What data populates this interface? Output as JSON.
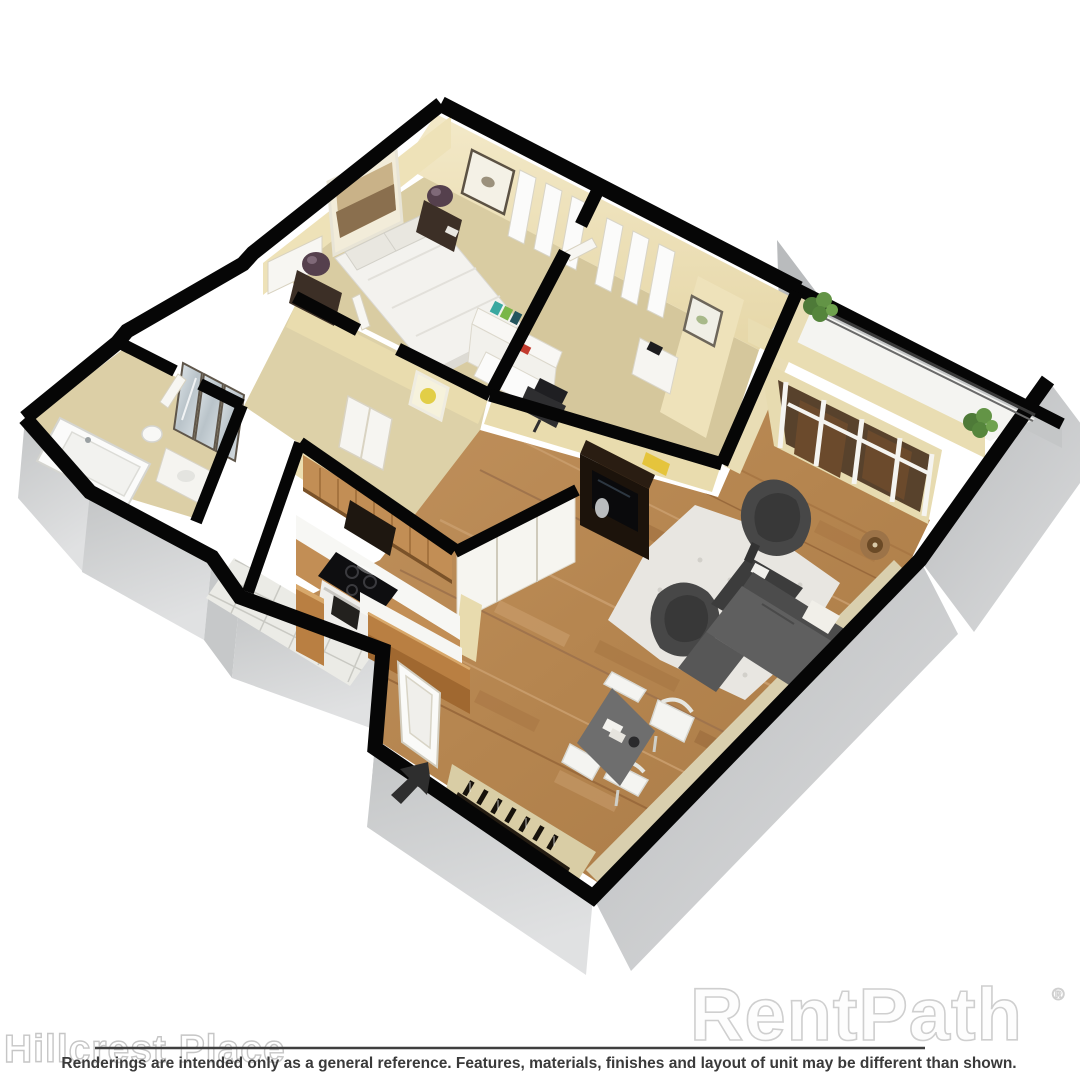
{
  "branding": {
    "property_name": "Hillcrest Place",
    "watermark": "RentPath",
    "registered_mark": "®"
  },
  "footer": {
    "disclaimer": "Renderings are intended only as a general reference. Features, materials, finishes and layout of unit may be different than shown."
  },
  "floor_plan": {
    "style": "3D isometric cutaway rendering of an apartment unit, viewed from above at 45 degrees",
    "rooms": [
      "master bedroom",
      "den office",
      "hallway with mirrored closets",
      "bathroom",
      "galley kitchen with breakfast bar",
      "living room",
      "dining area",
      "entry foyer with wine shelf",
      "balcony with railing and plants"
    ],
    "furniture": {
      "master_bedroom": [
        "queen bed with white bedding",
        "two dark nightstands",
        "two plum table lamps",
        "wide framed art",
        "butterfly framed art",
        "windows"
      ],
      "den": [
        "white desk with hutch shelves",
        "black office chair",
        "white dresser",
        "framed art",
        "windows"
      ],
      "bathroom": [
        "bathtub",
        "vanity",
        "toilet"
      ],
      "kitchen": [
        "oak upper cabinets",
        "white countertop",
        "range with black cooktop",
        "white tile floor",
        "island counter",
        "raised breakfast bar"
      ],
      "living_room": [
        "dark TV console with television",
        "two charcoal lounge chairs",
        "square charcoal coffee table",
        "gray sectional sofa with white pillow",
        "white shag rug",
        "bronze floor lamp",
        "sliding glass doors"
      ],
      "dining_area": [
        "square gray dining table",
        "four white chairs"
      ],
      "entry": [
        "front door",
        "black entry direction arrow",
        "shelf with bottles"
      ],
      "balcony": [
        "railing",
        "two green plants"
      ]
    },
    "flooring": {
      "bedroom_den_hall": "tan carpet",
      "kitchen_bath": "white tile / tan",
      "living_dining": "hardwood planks"
    }
  },
  "colors": {
    "background": "#ffffff",
    "wall_line": "#050505",
    "wall_face_cream": "#ecdfb4",
    "carpet_tan": "#d8cba0",
    "hardwood": "#b5854f",
    "exterior_gray": "#cccdce",
    "sofa_gray": "#5f5f5f",
    "accent_bar_wood": "#b97f42",
    "watermark_outline": "#cfcfcf",
    "disclaimer_text": "#3a3a3a"
  }
}
